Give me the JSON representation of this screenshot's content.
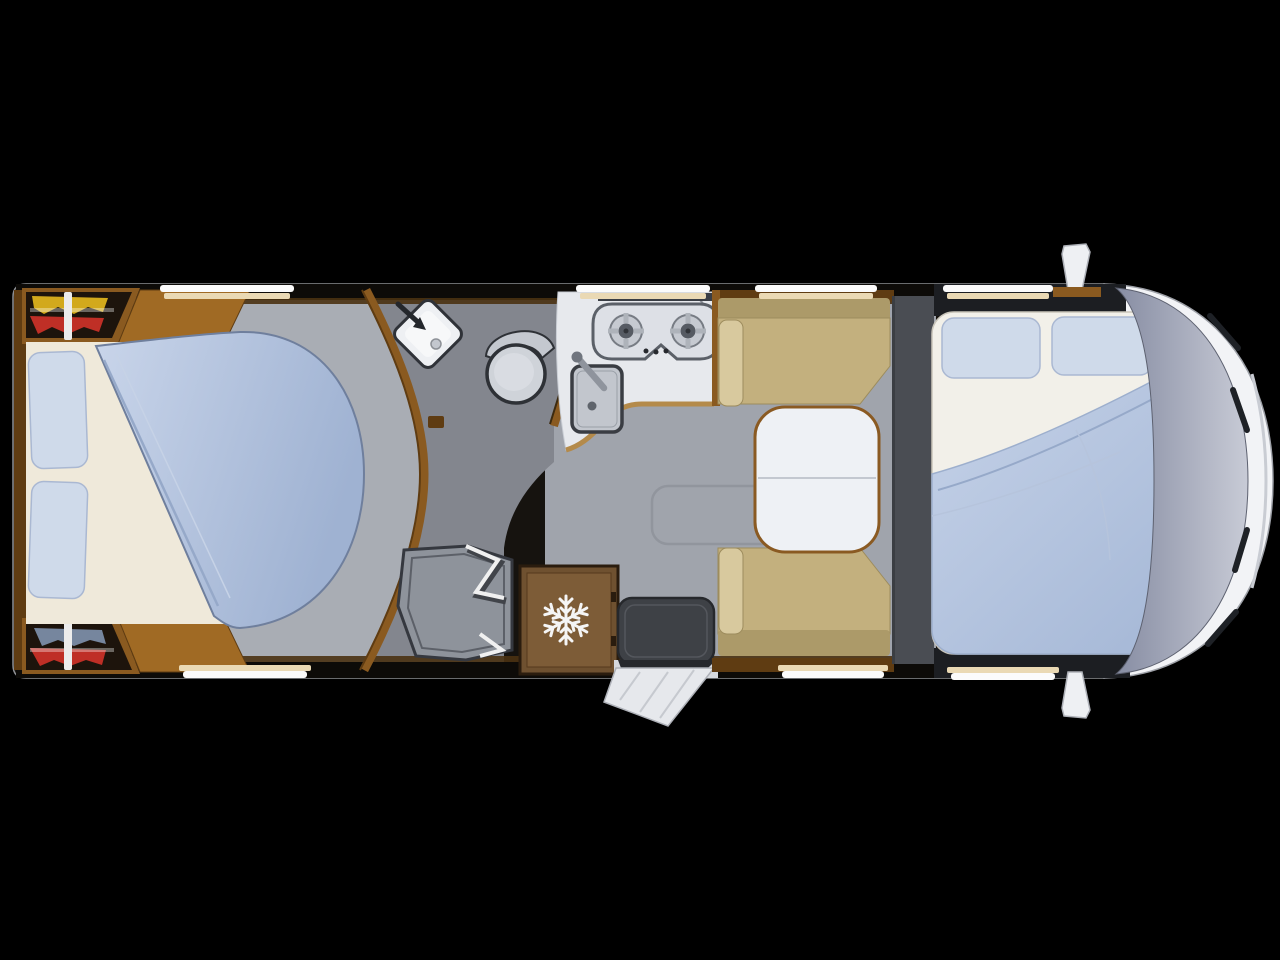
{
  "scene": {
    "subject": "motorhome-floorplan-top-view",
    "description": "Top-down rendered floor plan of a motorhome on a black background, cab at right",
    "background": "#000000"
  },
  "colors": {
    "bg": "#000000",
    "outline": "#8d8f93",
    "interior-dark": "#16130f",
    "wall-dark": "#0d0b08",
    "wood": "#8a5a20",
    "wood-dark": "#5f3c12",
    "wood-light": "#b48a4a",
    "wedge": "#a06a24",
    "floor": "#a0a4ac",
    "floor-bedroom": "#a9adb4",
    "bath-floor": "#83868e",
    "shower-tray": "#8e939b",
    "shower-line": "#35383f",
    "counter": "#e7e9ed",
    "steel-dark": "#3a3e45",
    "hob-line": "#5b6068",
    "burner": "#c6cad1",
    "burner-center": "#565b63",
    "sink": "#c2c6cd",
    "sink-line": "#3a3d43",
    "fridge": "#6f5130",
    "fridge-panel": "#7d5c37",
    "fridge-line": "#2a1c0e",
    "snow": "#f5f5f5",
    "bench": "#c3b07e",
    "bench-dark": "#ac9a69",
    "bench-light": "#d8c99e",
    "table": "#eef1f5",
    "charcoal": "#4a4d53",
    "cab-shadow": "#1c1e22",
    "sheet": "#f2f0e9",
    "sheet-warm": "#efe9da",
    "duvet-line": "#96a9c9",
    "pillow": "#cfdaea",
    "pillow-line": "#aab8d2",
    "window-white": "#fbfbfb",
    "window-warm": "#ead9b4",
    "cloth-yellow": "#d2a91c",
    "cloth-red": "#bf2f26",
    "cloth-blue": "#76869e",
    "rail": "#ececec",
    "wardrobe-dark": "#1d140c",
    "mat": "#3e4146",
    "door-white": "#e6e8ec",
    "body-white": "#f2f3f6",
    "body-shade": "#c9ccd3",
    "wiper": "#1e2126",
    "toilet": "#cfd3d9",
    "toilet-line": "#2e3136",
    "basin": "#eef0f3"
  },
  "areas": [
    {
      "name": "rear-bedroom",
      "items": [
        "wardrobe-top",
        "wardrobe-bottom",
        "island-bed",
        "pillows",
        "duvet"
      ]
    },
    {
      "name": "washroom",
      "items": [
        "washbasin",
        "toilet",
        "shower",
        "folding-shower-door"
      ]
    },
    {
      "name": "kitchen",
      "items": [
        "two-burner-hob",
        "sink",
        "worktop",
        "fridge"
      ]
    },
    {
      "name": "entrance",
      "items": [
        "door-mat",
        "entry-door-open"
      ]
    },
    {
      "name": "dinette",
      "items": [
        "bench-seat-top",
        "bench-seat-bottom",
        "table"
      ]
    },
    {
      "name": "front-bed",
      "items": [
        "pillow-left",
        "pillow-right",
        "duvet"
      ]
    },
    {
      "name": "cab",
      "items": [
        "windshield",
        "wipers",
        "hood",
        "mirror-top",
        "mirror-bottom"
      ]
    }
  ],
  "windows": {
    "top_count": 4,
    "bottom_count": 3
  }
}
